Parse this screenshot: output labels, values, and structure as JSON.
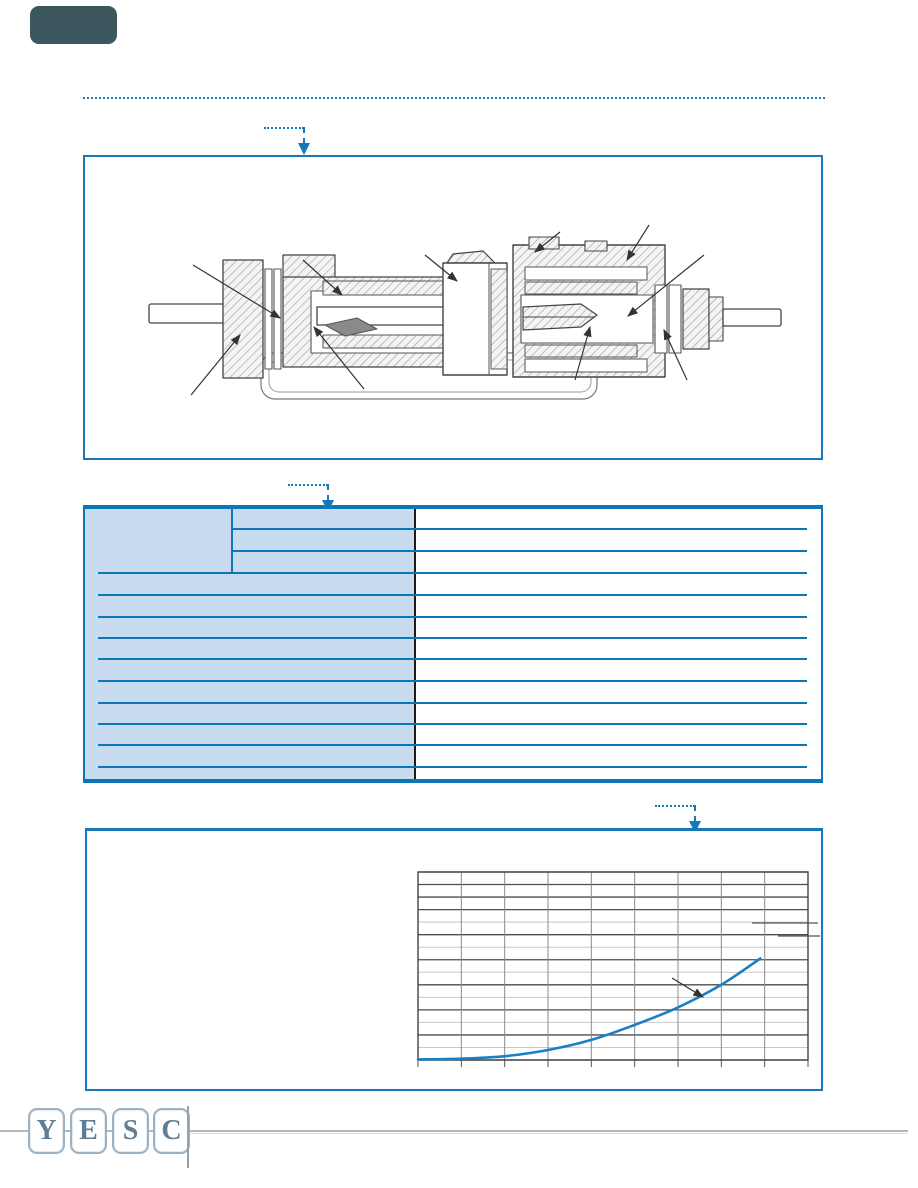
{
  "page": {
    "kind": "rf-connector datasheet page",
    "visible_text_note": "page template contains no body text; all table cells and chart labels are blank"
  },
  "colors": {
    "accent_blue": "#1579b9",
    "table_line_blue": "#0d76b8",
    "table_shade_blue": "#c9dbef",
    "table_divider_black": "#1c1c1c",
    "header_block_teal": "#3c585e",
    "curve_blue": "#1b7fc4",
    "grid_dark": "#4d4d4d",
    "grid_light": "#c8c8c8",
    "drawing_line": "#444444",
    "logo_steel": "#5f7e95",
    "footer_line_grey": "#b0b9c1"
  },
  "logo": {
    "letters": [
      "Y",
      "E",
      "S",
      "C"
    ]
  },
  "table": {
    "row_count": 13,
    "header_group_rows": 3,
    "left_region_shaded": true,
    "columns": 3,
    "all_cells_blank": true
  },
  "chart_data": {
    "type": "line",
    "title": "",
    "xlabel": "",
    "ylabel": "",
    "x_divisions": 9,
    "y_divisions": 15,
    "y_dark_line_indices": [
      0,
      1,
      2,
      3,
      5,
      7,
      9,
      11,
      13,
      15
    ],
    "series": [
      {
        "name": "mating-force-curve",
        "color": "#1b7fc4",
        "points_grid_units": [
          [
            0,
            0.05
          ],
          [
            1,
            0.1
          ],
          [
            2,
            0.3
          ],
          [
            3,
            0.8
          ],
          [
            4,
            1.6
          ],
          [
            5,
            2.8
          ],
          [
            6,
            4.2
          ],
          [
            7,
            6.0
          ],
          [
            7.9,
            8.1
          ]
        ]
      }
    ],
    "tick_labels": {
      "x": [],
      "y": []
    },
    "legend": "two unlabeled key lines at upper right",
    "grid": true
  }
}
